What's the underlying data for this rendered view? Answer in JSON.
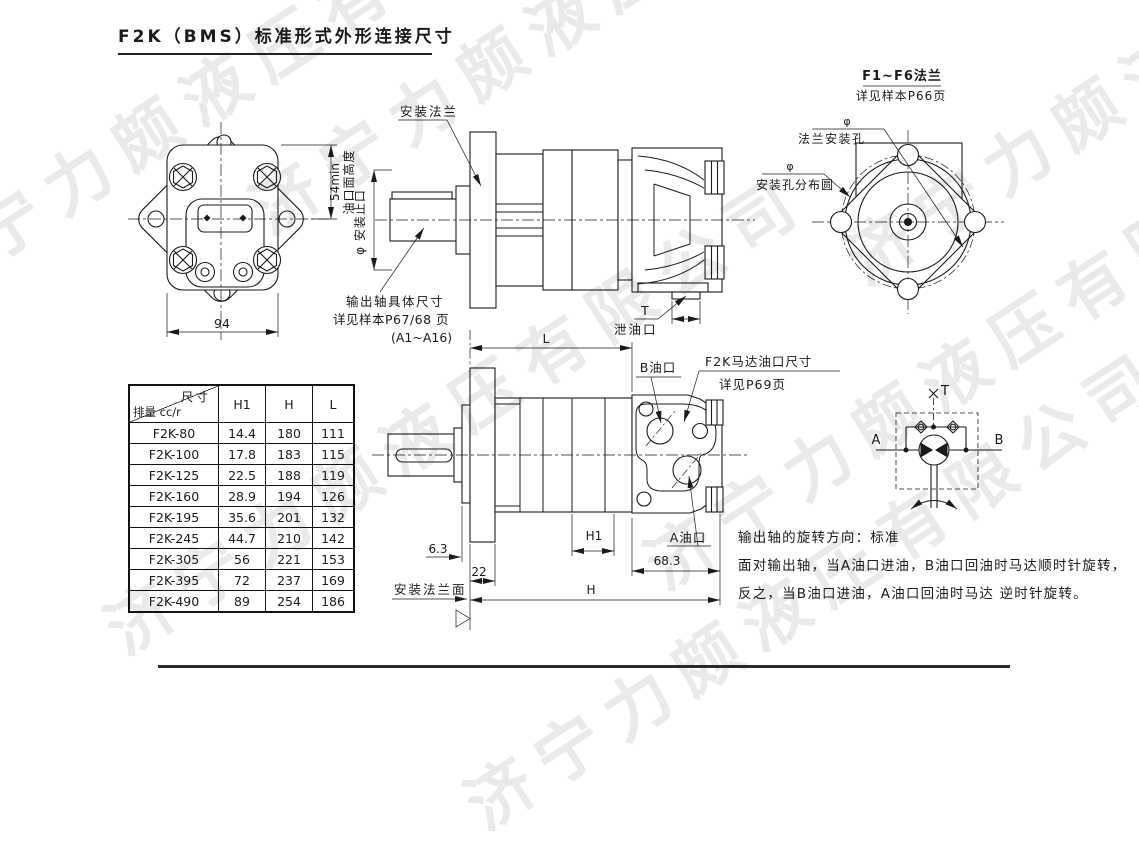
{
  "title": "F2K（BMS）标准形式外形连接尺寸",
  "watermark": {
    "text": "济宁力颇液压有限公司"
  },
  "left_view": {
    "dim_width": "94",
    "dim_height": "54min",
    "dim_height_label": "油口面高度"
  },
  "top_view": {
    "flange_label": "安装法兰",
    "spigot_label": "φ 安装止口",
    "shaft_note1": "输出轴具体尺寸",
    "shaft_note2": "详见样本P67/68 页",
    "shaft_note3": "(A1~A16)",
    "drain_t": "T",
    "drain_label": "泄油口"
  },
  "flange_view": {
    "title": "F1~F6法兰",
    "subtitle": "详见样本P66页",
    "hole_phi": "φ",
    "hole_label": "法兰安装孔",
    "circle_phi": "φ",
    "circle_label": "安装孔分布圆"
  },
  "bottom_view": {
    "dim_l": "L",
    "port_b": "B油口",
    "port_note1": "F2K马达油口尺寸",
    "port_note2": "详见P69页",
    "port_a": "A油口",
    "dim_6_3": "6.3",
    "dim_22": "22",
    "dim_h1": "H1",
    "dim_68_3": "68.3",
    "dim_h": "H",
    "mount_face_label": "安装法兰面"
  },
  "schematic": {
    "port_a": "A",
    "port_b": "B",
    "port_t": "T"
  },
  "rotation_note": {
    "line1": "输出轴的旋转方向：标准",
    "line2": "面对输出轴，当A油口进油，B油口回油时马达顺时针旋转，",
    "line3": "反之，当B油口进油，A油口回油时马达 逆时针旋转。"
  },
  "table": {
    "corner_top": "尺寸",
    "corner_bottom": "排量 cc/r",
    "columns": [
      "H1",
      "H",
      "L"
    ],
    "rows": [
      {
        "model": "F2K-80",
        "h1": "14.4",
        "h": "180",
        "l": "111"
      },
      {
        "model": "F2K-100",
        "h1": "17.8",
        "h": "183",
        "l": "115"
      },
      {
        "model": "F2K-125",
        "h1": "22.5",
        "h": "188",
        "l": "119"
      },
      {
        "model": "F2K-160",
        "h1": "28.9",
        "h": "194",
        "l": "126"
      },
      {
        "model": "F2K-195",
        "h1": "35.6",
        "h": "201",
        "l": "132"
      },
      {
        "model": "F2K-245",
        "h1": "44.7",
        "h": "210",
        "l": "142"
      },
      {
        "model": "F2K-305",
        "h1": "56",
        "h": "221",
        "l": "153"
      },
      {
        "model": "F2K-395",
        "h1": "72",
        "h": "237",
        "l": "169"
      },
      {
        "model": "F2K-490",
        "h1": "89",
        "h": "254",
        "l": "186"
      }
    ]
  }
}
